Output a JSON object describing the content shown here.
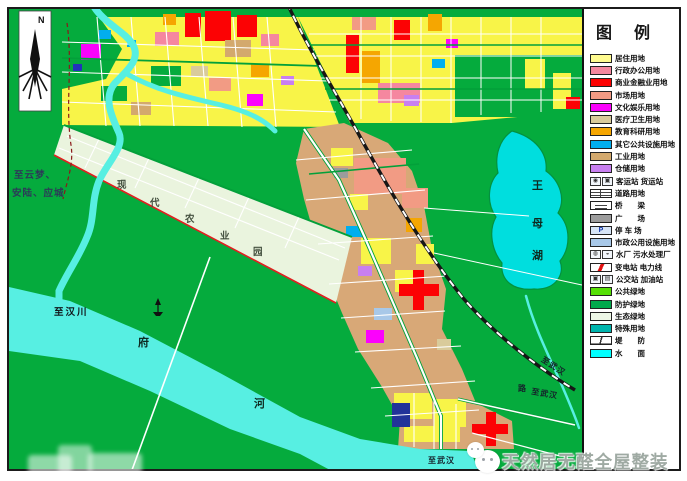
{
  "north": {
    "label": "N"
  },
  "legend": {
    "title": "图 例",
    "items": [
      {
        "label": "居住用地",
        "swatch": "color",
        "color": "#FFFB8F"
      },
      {
        "label": "行政办公用地",
        "swatch": "color",
        "color": "#F5879F"
      },
      {
        "label": "商业金融业用地",
        "swatch": "color",
        "color": "#FD0202"
      },
      {
        "label": "市场用地",
        "swatch": "color",
        "color": "#F29B84"
      },
      {
        "label": "文化娱乐用地",
        "swatch": "color",
        "color": "#FB02FC"
      },
      {
        "label": "医疗卫生用地",
        "swatch": "color",
        "color": "#D9CB9B"
      },
      {
        "label": "教育科研用地",
        "swatch": "color",
        "color": "#F5A601"
      },
      {
        "label": "其它公共设施用地",
        "swatch": "color",
        "color": "#02AEEE"
      },
      {
        "label": "工业用地",
        "swatch": "color",
        "color": "#D3A96D"
      },
      {
        "label": "仓储用地",
        "swatch": "color",
        "color": "#C87FF0"
      },
      {
        "label": "客运站 货运站",
        "swatch": "icons2",
        "icons": [
          "◉",
          "▣"
        ],
        "icon_names": [
          "passenger-station-icon",
          "freight-station-icon"
        ]
      },
      {
        "label": "道路用地",
        "swatch": "road",
        "icon_name": "road-swatch-icon"
      },
      {
        "label": "桥　　梁",
        "swatch": "bridge",
        "icon_name": "bridge-swatch-icon"
      },
      {
        "label": "广　　场",
        "swatch": "color",
        "color": "#9C9C9C"
      },
      {
        "label": "停 车 场",
        "swatch": "parking",
        "letter": "P",
        "icon_name": "parking-icon"
      },
      {
        "label": "市政公用设施用地",
        "swatch": "color",
        "color": "#A8C8E8"
      },
      {
        "label": "水厂 污水处理厂",
        "swatch": "icons2",
        "icons": [
          "◍",
          "◒"
        ],
        "icon_names": [
          "water-plant-icon",
          "sewage-plant-icon"
        ]
      },
      {
        "label": "变电站 电力线",
        "swatch": "power",
        "icon_name": "substation-powerline-icon"
      },
      {
        "label": "公交站 加油站",
        "swatch": "icons2",
        "icons": [
          "▣",
          "▤"
        ],
        "icon_names": [
          "bus-station-icon",
          "gas-station-icon"
        ]
      },
      {
        "label": "公共绿地",
        "swatch": "color",
        "color": "#55DF05"
      },
      {
        "label": "防护绿地",
        "swatch": "color",
        "color": "#01A94C"
      },
      {
        "label": "生态绿地",
        "swatch": "color",
        "color": "#EDF7E6"
      },
      {
        "label": "特殊用地",
        "swatch": "color",
        "color": "#01B5AE"
      },
      {
        "label": "堤　　防",
        "swatch": "levee",
        "icon_name": "levee-swatch-icon"
      },
      {
        "label": "水　　面",
        "swatch": "color",
        "color": "#01FFFF"
      }
    ]
  },
  "map_labels": [
    {
      "text": "至云梦、",
      "x": 14,
      "y": 171,
      "cls": "ml-dest"
    },
    {
      "text": "安陆、应城",
      "x": 12,
      "y": 189,
      "cls": "ml-dest"
    },
    {
      "text": "至汉川",
      "x": 54,
      "y": 308,
      "cls": "ml-place"
    },
    {
      "text": "府",
      "x": 138,
      "y": 338,
      "cls": "ml-river"
    },
    {
      "text": "河",
      "x": 254,
      "y": 399,
      "cls": "ml-river"
    },
    {
      "text": "王",
      "x": 532,
      "y": 181,
      "cls": "ml-river"
    },
    {
      "text": "母",
      "x": 532,
      "y": 219,
      "cls": "ml-river"
    },
    {
      "text": "湖",
      "x": 532,
      "y": 251,
      "cls": "ml-river"
    },
    {
      "text": "现",
      "x": 117,
      "y": 181,
      "cls": "ml-zone"
    },
    {
      "text": "代",
      "x": 150,
      "y": 199,
      "cls": "ml-zone"
    },
    {
      "text": "农",
      "x": 185,
      "y": 215,
      "cls": "ml-zone"
    },
    {
      "text": "业",
      "x": 220,
      "y": 232,
      "cls": "ml-zone"
    },
    {
      "text": "园",
      "x": 253,
      "y": 248,
      "cls": "ml-zone"
    },
    {
      "text": "至武汉",
      "x": 544,
      "y": 356,
      "rot": 33,
      "cls": "ml-place-sm"
    },
    {
      "text": "路",
      "x": 518,
      "y": 385,
      "cls": "ml-place-sm"
    },
    {
      "text": "至武汉",
      "x": 532,
      "y": 388,
      "rot": 10,
      "cls": "ml-place-sm"
    },
    {
      "text": "至武汉",
      "x": 428,
      "y": 457,
      "cls": "ml-place-sm"
    }
  ],
  "watermark": {
    "text": "天然居无醛全屋整装"
  },
  "map_colors": {
    "base_green": "#05AB3D",
    "water_river": "#57EFE2",
    "water_lake": "#00DEDE",
    "residential_yellow": "#F8F448",
    "industrial_tan": "#D8A877",
    "eco_band": "#EAF4DE",
    "railway": "#161616"
  }
}
